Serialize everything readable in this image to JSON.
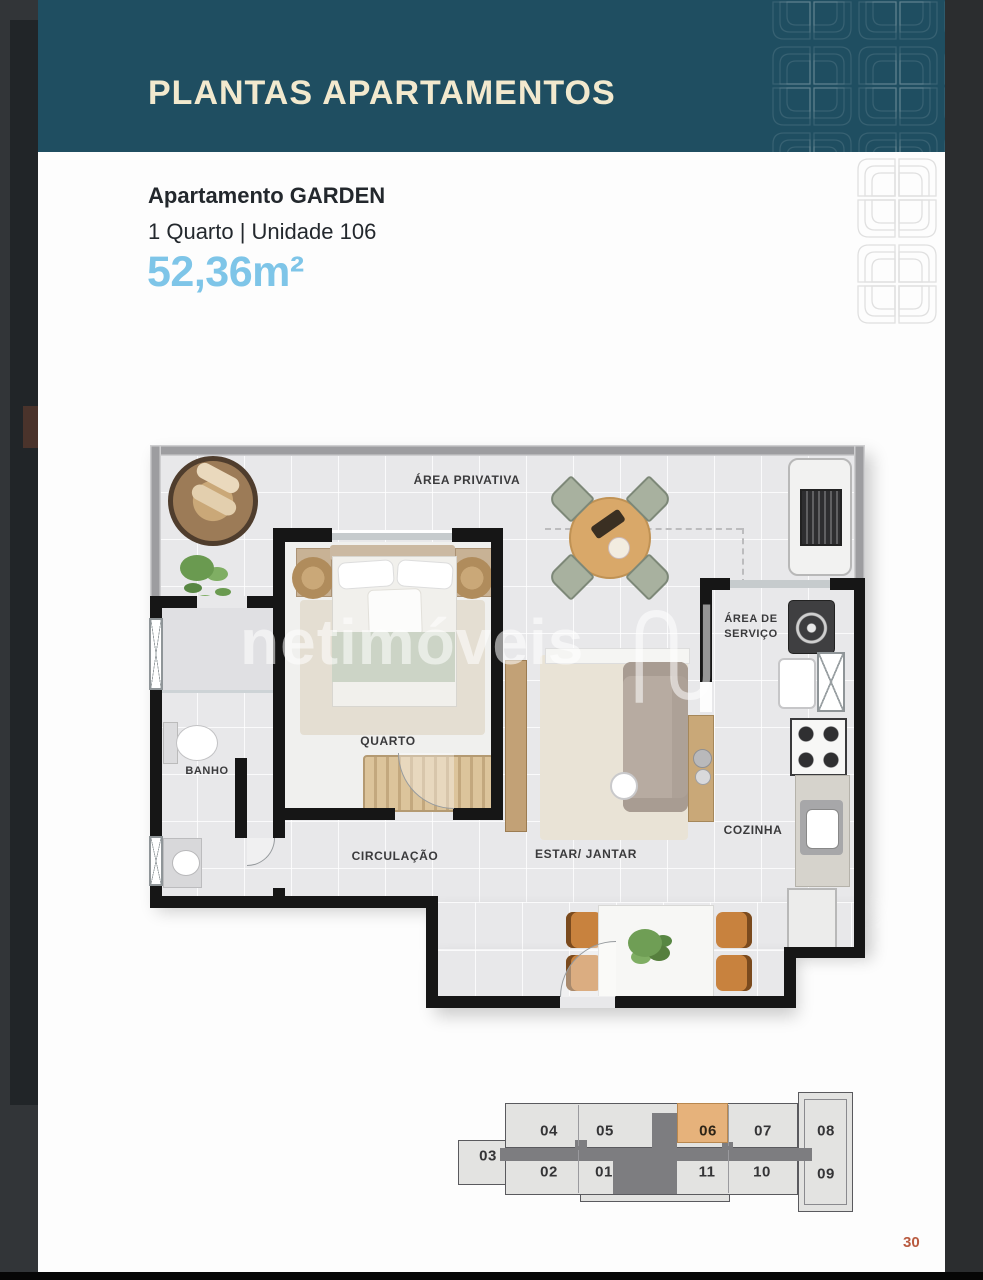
{
  "header": {
    "title": "PLANTAS APARTAMENTOS"
  },
  "apartment": {
    "name": "Apartamento GARDEN",
    "details": "1 Quarto | Unidade 106",
    "area": "52,36m²"
  },
  "floorplan": {
    "watermark": "netimóveis",
    "labels": {
      "area_privativa": "ÁREA PRIVATIVA",
      "area_servico_line1": "ÁREA DE",
      "area_servico_line2": "SERVIÇO",
      "quarto": "QUARTO",
      "banho": "BANHO",
      "circulacao": "CIRCULAÇÃO",
      "estar_jantar": "ESTAR/ JANTAR",
      "cozinha": "COZINHA"
    }
  },
  "keyplan": {
    "units": [
      {
        "label": "04",
        "highlighted": false
      },
      {
        "label": "05",
        "highlighted": false
      },
      {
        "label": "06",
        "highlighted": true
      },
      {
        "label": "07",
        "highlighted": false
      },
      {
        "label": "08",
        "highlighted": false
      },
      {
        "label": "03",
        "highlighted": false
      },
      {
        "label": "02",
        "highlighted": false
      },
      {
        "label": "01",
        "highlighted": false
      },
      {
        "label": "11",
        "highlighted": false
      },
      {
        "label": "10",
        "highlighted": false
      },
      {
        "label": "09",
        "highlighted": false
      }
    ]
  },
  "page_number": "30",
  "colors": {
    "header_bg": "#1F4E61",
    "title_text": "#F2E9CE",
    "area_text": "#7EC5E8",
    "highlight_unit": "#E6B27B",
    "page_number": "#B95B40"
  }
}
